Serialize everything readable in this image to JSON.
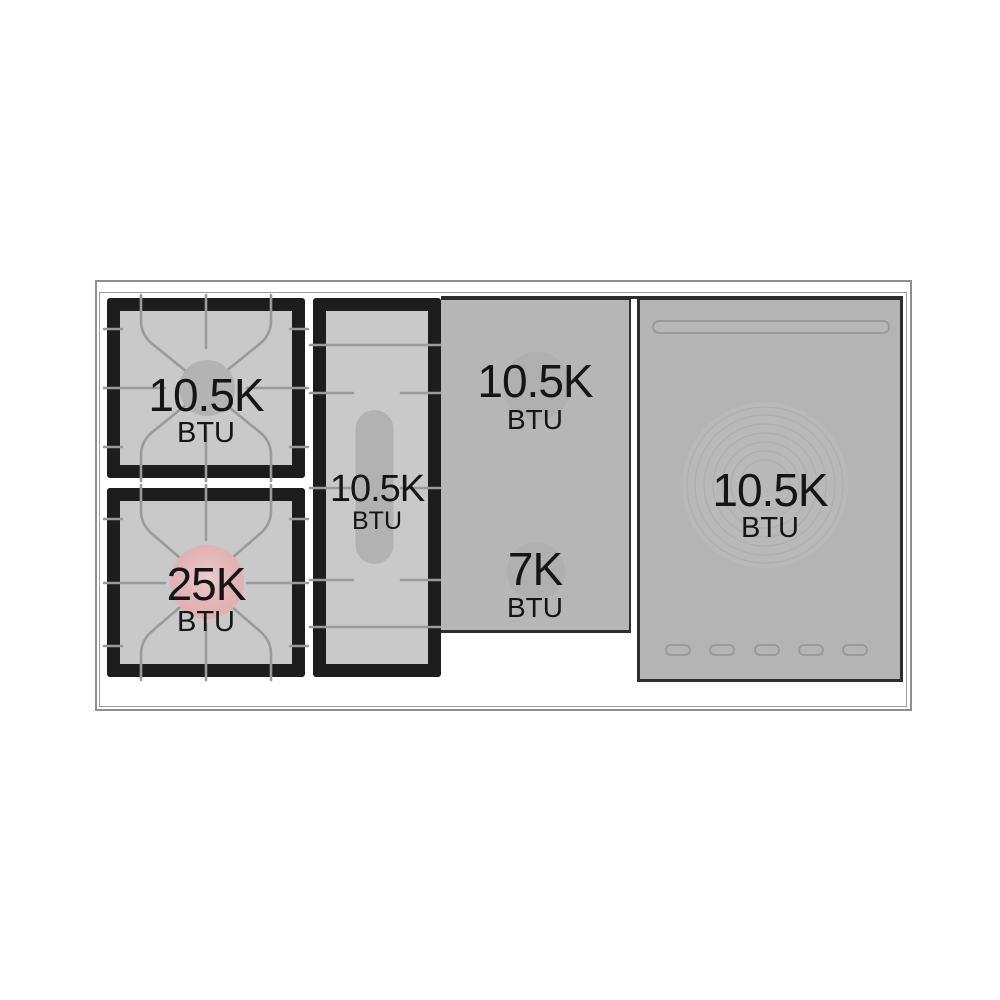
{
  "diagram": {
    "unit_label": "BTU",
    "modules": [
      {
        "name": "top-left-burner",
        "power": "10.5K",
        "unit": "BTU"
      },
      {
        "name": "bottom-left-burner",
        "power": "25K",
        "unit": "BTU"
      },
      {
        "name": "center-griddle-burner",
        "power": "10.5K",
        "unit": "BTU"
      },
      {
        "name": "middle-top-burner",
        "power": "10.5K",
        "unit": "BTU"
      },
      {
        "name": "middle-bottom-burner",
        "power": "7K",
        "unit": "BTU"
      },
      {
        "name": "french-top-plate",
        "power": "10.5K",
        "unit": "BTU"
      }
    ],
    "colors": {
      "frame_black": "#1d1d1d",
      "grate_surface": "#c9c9c9",
      "panel_gray": "#b5b5b5",
      "burner_cap_gray": "#b2b2b2",
      "high_output_pink": "#dfadaf",
      "tick_line_gray": "#9a9a9a",
      "outline_gray": "#8f8f8f",
      "text_black": "#151515"
    }
  }
}
